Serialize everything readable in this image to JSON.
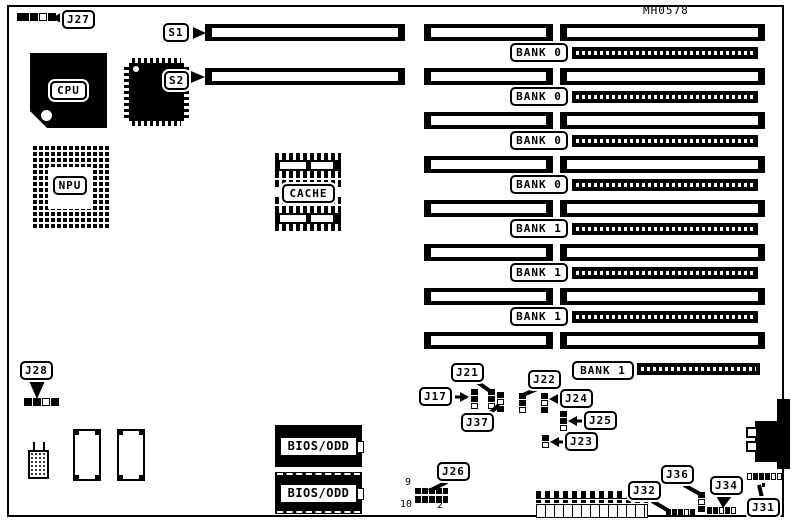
{
  "title": "MH0578",
  "colors": {
    "ink": "#000000",
    "paper": "#ffffff"
  },
  "chips": {
    "cpu": {
      "label": "CPU"
    },
    "npu": {
      "label": "NPU"
    },
    "cache": {
      "label": "CACHE"
    },
    "bios_top": {
      "label": "BIOS/ODD"
    },
    "bios_bottom": {
      "label": "BIOS/ODD"
    }
  },
  "slots": {
    "s1": {
      "label": "S1"
    },
    "s2": {
      "label": "S2"
    }
  },
  "memory_banks": [
    "BANK 0",
    "BANK 0",
    "BANK 0",
    "BANK 0",
    "BANK 1",
    "BANK 1",
    "BANK 1",
    "BANK 1"
  ],
  "jumpers": {
    "j27": {
      "label": "J27"
    },
    "j28": {
      "label": "J28"
    },
    "j17": {
      "label": "J17"
    },
    "j21": {
      "label": "J21"
    },
    "j37": {
      "label": "J37"
    },
    "j22": {
      "label": "J22"
    },
    "j24": {
      "label": "J24"
    },
    "j25": {
      "label": "J25"
    },
    "j23": {
      "label": "J23"
    },
    "j26": {
      "label": "J26",
      "pin9": "9",
      "pin10": "10",
      "pin2": "2"
    },
    "j32": {
      "label": "J32"
    },
    "j36": {
      "label": "J36"
    },
    "j34": {
      "label": "J34"
    },
    "j31": {
      "label": "J31"
    }
  }
}
